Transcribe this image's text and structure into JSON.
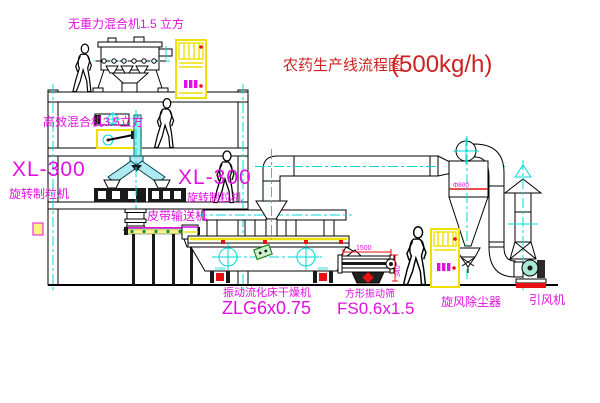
{
  "title": {
    "name": "农药生产线流程图",
    "capacity": "(500kg/h)"
  },
  "equipment": {
    "roof_mixer": "无重力混合机1.5 立方",
    "floor_mixer": "高效混合机3.5立方",
    "granulator_left_model": "XL-300",
    "granulator_left_name": "旋转制粒机",
    "granulator_right_model": "XL-300",
    "granulator_right_name": "旋转制粒机",
    "belt_conveyor": "皮带输送机",
    "dryer_name": "振动流化床干燥机",
    "dryer_model": "ZLG6x0.75",
    "screen_name": "方形振动筛",
    "screen_model": "FS0.6x1.5",
    "cyclone_name": "旋风除尘器",
    "fan_name": "引风机"
  },
  "dimensions": {
    "cyclone_diameter": "Φ800",
    "screen_length": "1500",
    "screen_height": "340"
  },
  "colors": {
    "label_magenta": "#e010e0",
    "title_red": "#cc2222",
    "centerline_cyan": "#00d8d8",
    "cabinet_yellow": "#f0e000",
    "accent_red": "#e81010",
    "accent_green": "#009050"
  }
}
